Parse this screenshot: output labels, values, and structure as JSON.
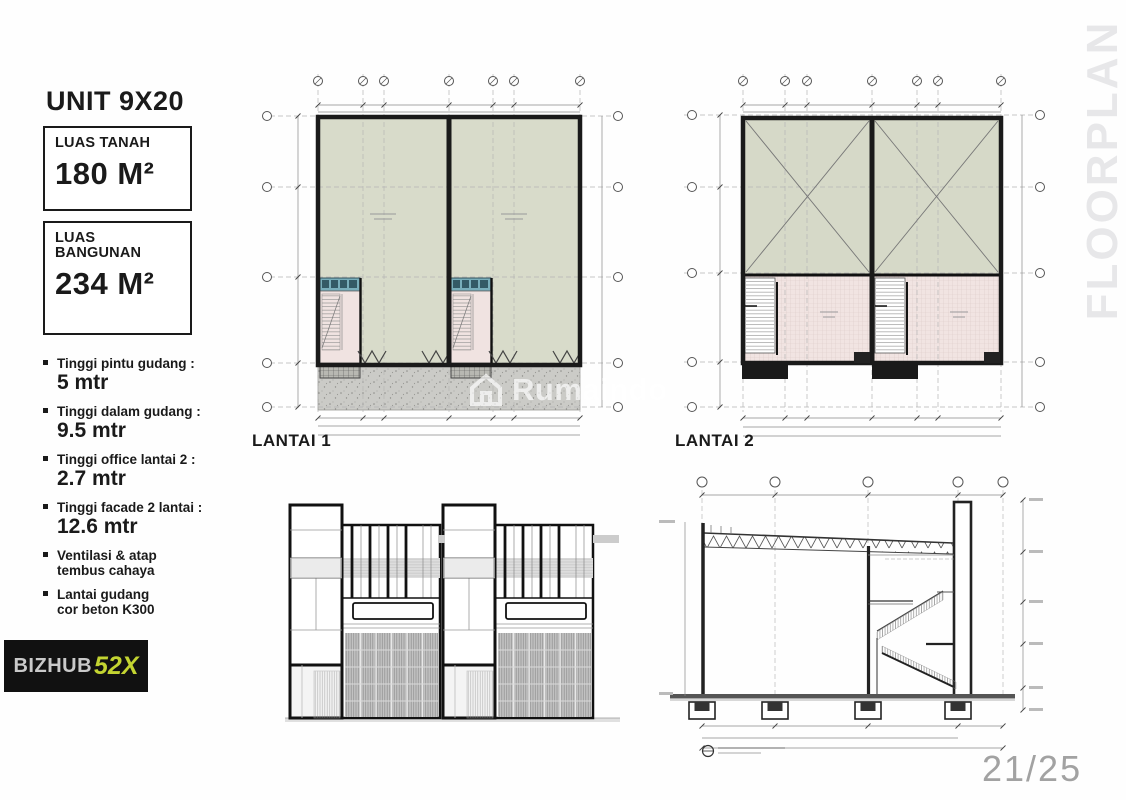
{
  "page": {
    "side_label": "FLOORPLAN",
    "page_number": "21/25",
    "watermark": "Rumaindo"
  },
  "sidebar": {
    "title": "UNIT 9X20",
    "cards": [
      {
        "label_lines": [
          "LUAS TANAH"
        ],
        "value": "180 M²"
      },
      {
        "label_lines": [
          "LUAS",
          "BANGUNAN"
        ],
        "value": "234 M²"
      }
    ],
    "specs": [
      {
        "title": "Tinggi pintu gudang :",
        "value": "5 mtr"
      },
      {
        "title": "Tinggi dalam gudang :",
        "value": "9.5 mtr"
      },
      {
        "title": "Tinggi office lantai 2 :",
        "value": "2.7 mtr"
      },
      {
        "title": "Tinggi facade 2 lantai :",
        "value": "12.6 mtr"
      },
      {
        "title": "Ventilasi & atap",
        "title2": "tembus cahaya"
      },
      {
        "title": "Lantai gudang",
        "title2": "cor beton K300"
      }
    ]
  },
  "logo": {
    "brand": "BIZHUB",
    "suffix": "52X",
    "accent": "#c3d431"
  },
  "plans": {
    "lantai1": {
      "label": "LANTAI 1"
    },
    "lantai2": {
      "label": "LANTAI 2"
    }
  },
  "colors": {
    "warehouse_floor": "#d8dbca",
    "void_area": "#d6d9c8",
    "office_floor": "#f1e4e2",
    "toilet_strip": "#79aebb",
    "concrete_apron": "#cbcbc7",
    "wall": "#1a1a1a"
  }
}
